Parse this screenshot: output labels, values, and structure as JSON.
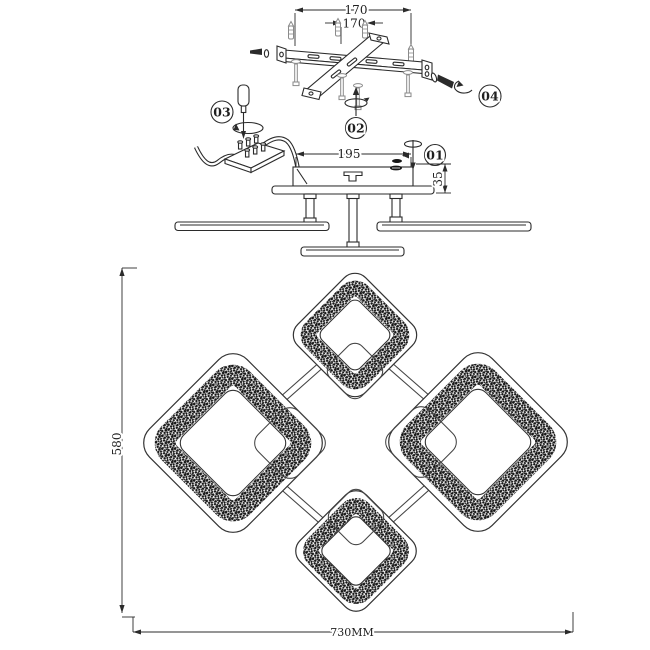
{
  "drawing": {
    "kind": "ceiling-light installation diagram",
    "views": [
      "mounting-hardware",
      "canopy-side-view",
      "fixture-plan-view"
    ]
  },
  "dimensions": {
    "bracket_outer_spacing": "170",
    "bracket_inner_spacing": "170",
    "canopy_width": "195",
    "canopy_height": "35",
    "fixture_depth": "580",
    "fixture_width": "730MM"
  },
  "step_labels": {
    "step1": "01",
    "step2": "02",
    "step3": "03",
    "step4": "04"
  },
  "colors": {
    "line": "#2b2b2b",
    "speckle": "#161616",
    "background": "#ffffff"
  }
}
